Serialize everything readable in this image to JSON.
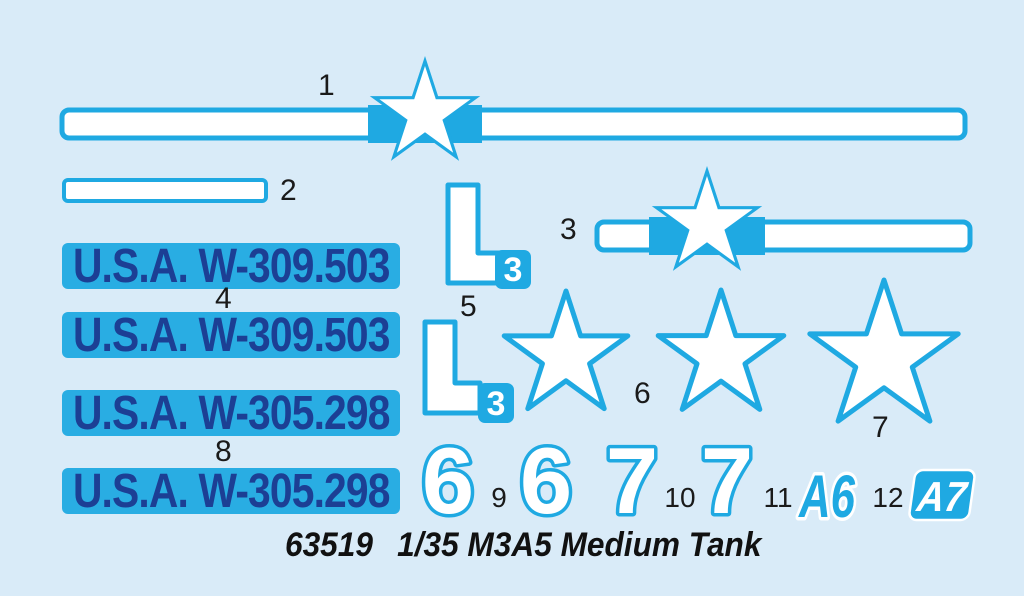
{
  "colors": {
    "background": "#d9ebf8",
    "cyan": "#1fa9e2",
    "plate_blue": "#29ade3",
    "navy_text": "#1c3f94",
    "label_black": "#1a1a1a"
  },
  "part_labels": {
    "1": "1",
    "2": "2",
    "3": "3",
    "4": "4",
    "5": "5",
    "6": "6",
    "7": "7",
    "8": "8",
    "9": "9",
    "10": "10",
    "11": "11",
    "12": "12"
  },
  "decals": {
    "registration_upper": "U.S.A. W-309.503",
    "registration_lower": "U.S.A. W-305.298",
    "bracket_badge": "3",
    "digit_six": "6",
    "digit_seven": "7",
    "code_a6": "A6",
    "code_a7": "A7"
  },
  "footer": {
    "kit_number": "63519",
    "kit_name": "1/35 M3A5 Medium Tank"
  }
}
